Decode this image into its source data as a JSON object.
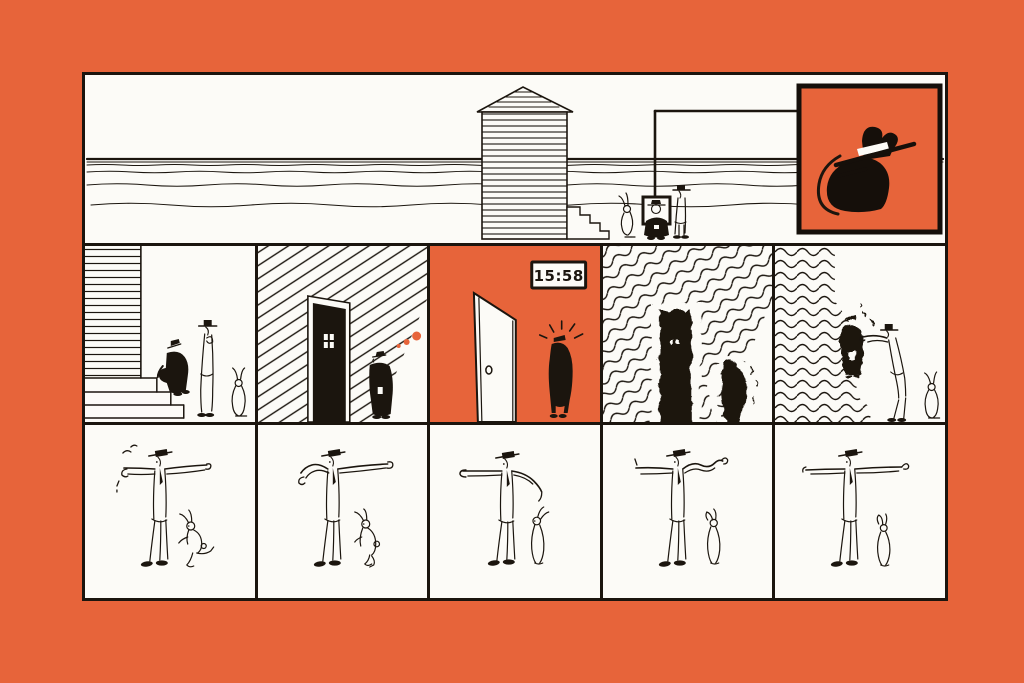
{
  "page": {
    "type": "comic-strip-page",
    "background_color": "#E7643A",
    "ink_color": "#1B150E",
    "paper_color": "#FCFBF7"
  },
  "top_panel": {
    "name": "beach-scene",
    "scenery": [
      "sea-horizon-waves",
      "striped-beach-hut",
      "hut-steps",
      "sign-post"
    ],
    "figures": [
      "rabbit",
      "short-man-reading-sign",
      "tall-man"
    ],
    "inset_sign": {
      "name": "hat-and-rock-pictogram",
      "background_color": "#E7643A"
    }
  },
  "middle_panels": [
    {
      "name": "staircase-scene",
      "figures": [
        "short-man-climbing",
        "tall-man-waiting",
        "rabbit"
      ]
    },
    {
      "name": "closed-black-door-scene",
      "figures": [
        "short-man-looking-up"
      ],
      "thought_dots_count": 3,
      "thought_dots_color": "#E7643A"
    },
    {
      "name": "open-white-door-scene",
      "clock_time": "15:58",
      "background_color": "#E7643A",
      "figures": [
        "short-man-startled"
      ]
    },
    {
      "name": "wavering-door-scene",
      "figures": [
        "short-man-trembling"
      ]
    },
    {
      "name": "wavering-wall-scene",
      "figures": [
        "short-man-trembling",
        "tall-man-reaching-out",
        "rabbit"
      ]
    }
  ],
  "bottom_panels": [
    {
      "name": "arms-out-pose-1",
      "figures": [
        "tall-man-arms-outstretched",
        "rabbit-leaping"
      ]
    },
    {
      "name": "arms-out-pose-2",
      "figures": [
        "tall-man-one-arm-bent",
        "rabbit-hopping"
      ]
    },
    {
      "name": "arms-out-pose-3",
      "figures": [
        "tall-man-pointing-left",
        "rabbit-standing"
      ]
    },
    {
      "name": "arms-out-pose-4",
      "figures": [
        "tall-man-arm-waving",
        "rabbit-slumping"
      ]
    },
    {
      "name": "arms-out-pose-5",
      "figures": [
        "tall-man-arms-level",
        "rabbit-dejected"
      ]
    }
  ]
}
